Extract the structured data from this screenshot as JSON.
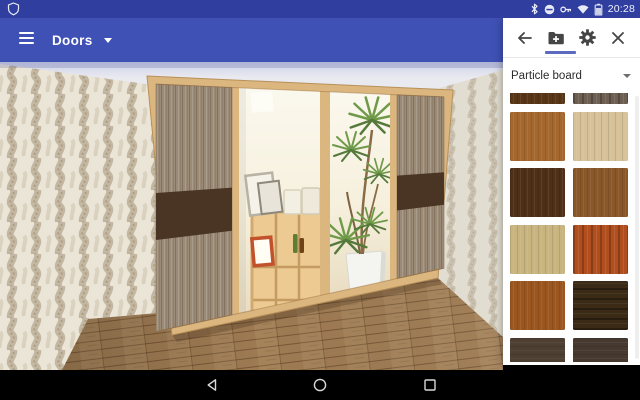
{
  "status_bar": {
    "time": "20:28",
    "bg_color": "#303f9f",
    "left_icons": [
      "shield-icon"
    ],
    "right_icons": [
      "bluetooth-icon",
      "do-not-disturb-icon",
      "key-icon",
      "wifi-icon",
      "battery-icon"
    ]
  },
  "app_bar": {
    "title": "Doors",
    "bg_color": "#3f51b5",
    "icons": [
      "menu-icon",
      "dropdown-caret-icon"
    ]
  },
  "side_panel": {
    "toolbar": {
      "icons": [
        "back-arrow-icon",
        "add-folder-icon",
        "settings-gear-icon",
        "close-icon"
      ],
      "active_tab": "add-folder",
      "accent_color": "#5c6bc0"
    },
    "material_select": {
      "value": "Particle board"
    },
    "swatches": [
      {
        "base": "#573517",
        "grain": "vertical"
      },
      {
        "base": "#6d5f51",
        "grain": "vertical-strong"
      },
      {
        "base": "#a4682e",
        "grain": "vertical"
      },
      {
        "base": "#d6c199",
        "grain": "vertical"
      },
      {
        "base": "#4e2f17",
        "grain": "vertical"
      },
      {
        "base": "#8a5728",
        "grain": "vertical"
      },
      {
        "base": "#c9b480",
        "grain": "vertical"
      },
      {
        "base": "#b14e1e",
        "grain": "vertical-strong"
      },
      {
        "base": "#9b561f",
        "grain": "vertical"
      },
      {
        "base": "#3a2a16",
        "grain": "horizontal-strong"
      },
      {
        "base": "#4e3f33",
        "grain": "horizontal"
      },
      {
        "base": "#463a30",
        "grain": "horizontal"
      }
    ]
  },
  "scene": {
    "colors": {
      "wardrobe_frame": "#dbb67e",
      "door_wood": "#9a8a76",
      "door_band": "#4a3424",
      "floor": "#9d7a52",
      "wallpaper": "#ebe5d8",
      "ceiling": "#e9e9f0",
      "mirror": "#f8f4e7"
    },
    "wardrobe_doors": 4,
    "mirror_doors": 2
  },
  "nav_bar": {
    "bg_color": "#000000",
    "icons": [
      "back-nav-icon",
      "home-nav-icon",
      "recents-nav-icon"
    ]
  }
}
